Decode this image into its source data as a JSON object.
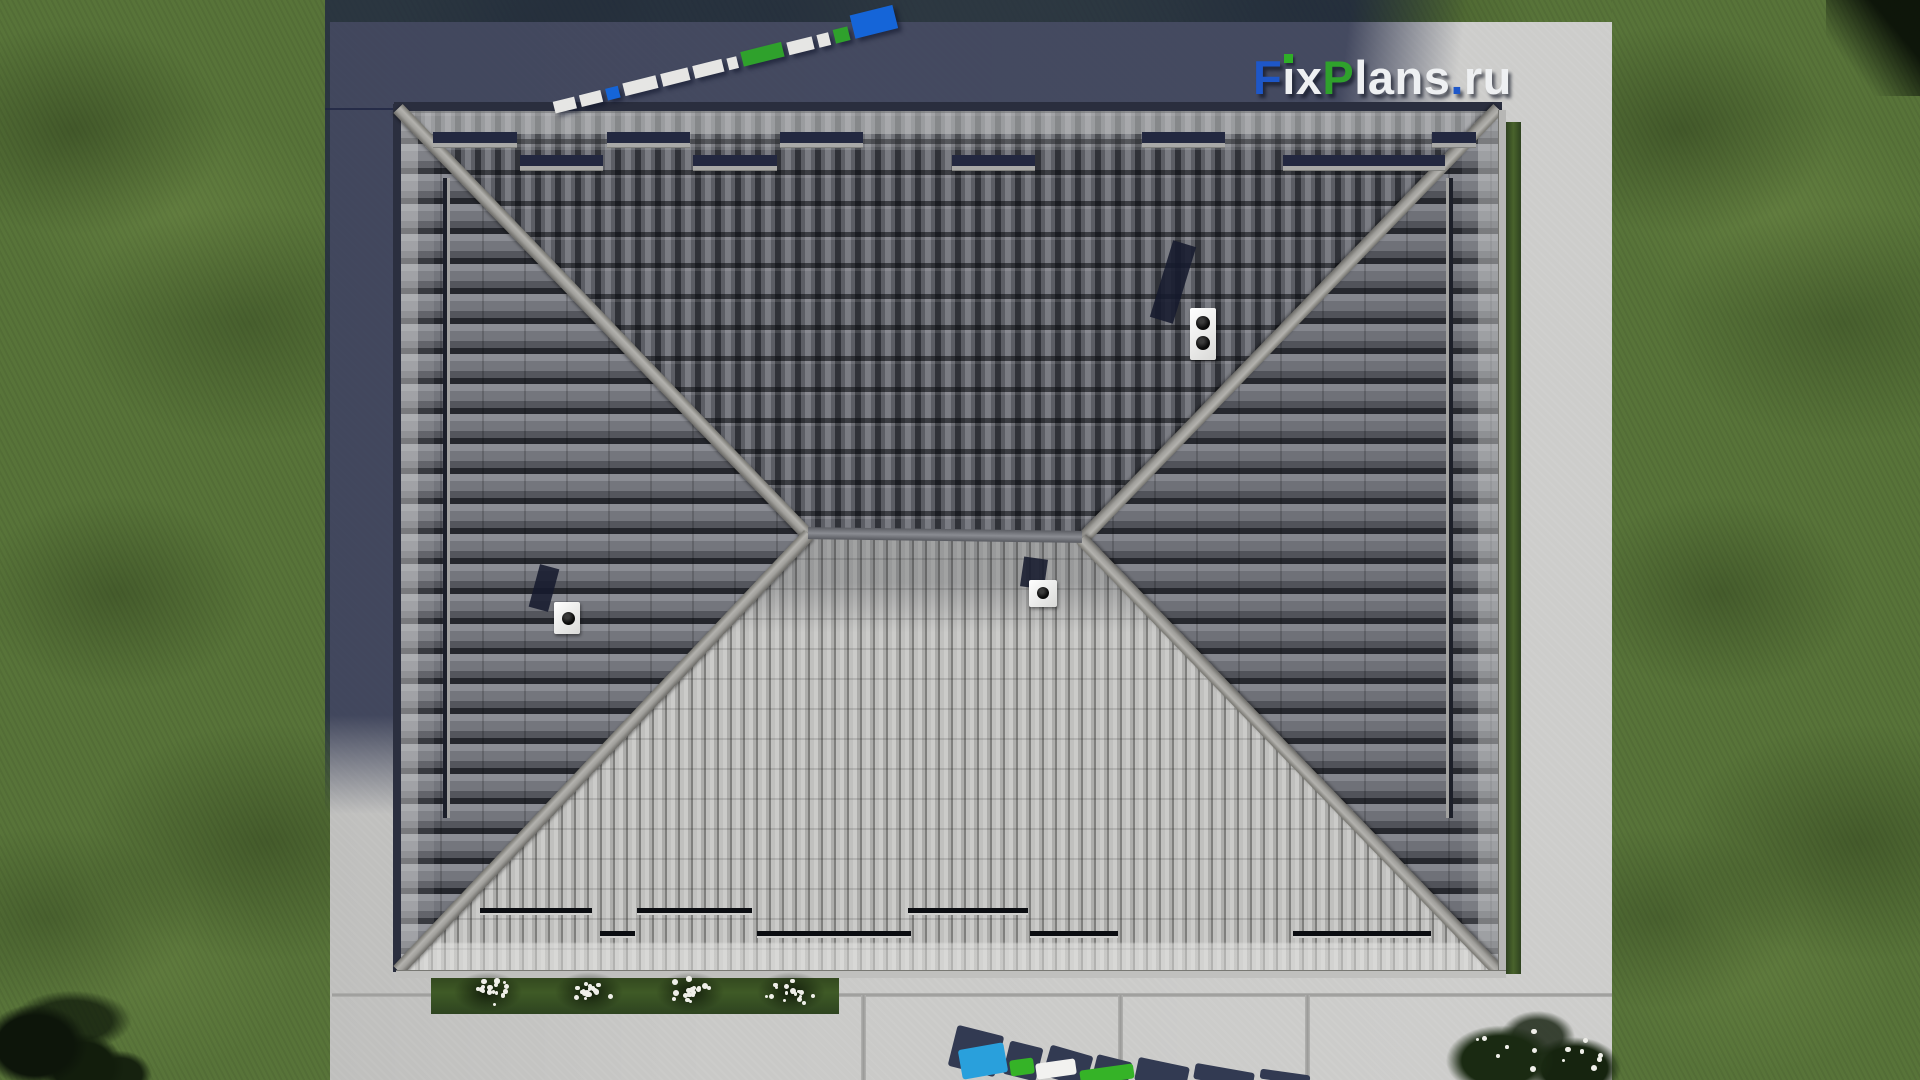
{
  "watermark_logo": {
    "text": "FixPlans.ru",
    "seg_f": "F",
    "seg_i_stem": "ı",
    "seg_x": "x",
    "seg_p": "P",
    "seg_lans": "lans",
    "seg_dot": ".",
    "seg_ru": "ru",
    "color_blue": "#1e57c8",
    "color_green": "#2fa12c",
    "color_white": "#eef0f2"
  },
  "scene_colors": {
    "grass": "#587439",
    "concrete": "#c9c9c7",
    "house_shadow": "#1e2542",
    "roof_north_tiles": "#4a4c52",
    "roof_south_tiles": "#b3b3b1",
    "roof_side_tiles": "#5e6067",
    "hip_cap": "#a6a5a1",
    "hedge_green": "#3f5a26",
    "azure_block": "#29a0dc"
  },
  "scalebar_blocks": [
    {
      "w": 22,
      "h": 12,
      "c": "#e6e6e4"
    },
    {
      "w": 22,
      "h": 12,
      "c": "#e6e6e4"
    },
    {
      "w": 13,
      "h": 12,
      "c": "#1565d8"
    },
    {
      "w": 34,
      "h": 13,
      "c": "#e6e6e4"
    },
    {
      "w": 28,
      "h": 13,
      "c": "#e6e6e4"
    },
    {
      "w": 30,
      "h": 13,
      "c": "#e6e6e4"
    },
    {
      "w": 10,
      "h": 12,
      "c": "#e6e6e4"
    },
    {
      "w": 42,
      "h": 15,
      "c": "#2fa12c"
    },
    {
      "w": 26,
      "h": 13,
      "c": "#e6e6e4"
    },
    {
      "w": 12,
      "h": 13,
      "c": "#e6e6e4"
    },
    {
      "w": 15,
      "h": 14,
      "c": "#2fa12c"
    },
    {
      "w": 44,
      "h": 24,
      "c": "#1565d8"
    }
  ],
  "bottom_mark": {
    "shadows": [
      {
        "x": 22,
        "y": 8,
        "w": 48,
        "h": 42,
        "r": 14
      },
      {
        "x": 76,
        "y": 22,
        "w": 34,
        "h": 34,
        "r": 14
      },
      {
        "x": 116,
        "y": 28,
        "w": 44,
        "h": 32,
        "r": 16
      },
      {
        "x": 164,
        "y": 36,
        "w": 36,
        "h": 26,
        "r": 14
      },
      {
        "x": 206,
        "y": 40,
        "w": 52,
        "h": 24,
        "r": 12
      },
      {
        "x": 264,
        "y": 46,
        "w": 60,
        "h": 16,
        "r": 10
      },
      {
        "x": 330,
        "y": 50,
        "w": 50,
        "h": 10,
        "r": 8
      }
    ],
    "tops": [
      {
        "x": 30,
        "y": 24,
        "w": 46,
        "h": 30,
        "r": -10,
        "c": "#29a0dc"
      },
      {
        "x": 80,
        "y": 37,
        "w": 24,
        "h": 16,
        "r": -8,
        "c": "#35b327"
      },
      {
        "x": 106,
        "y": 39,
        "w": 40,
        "h": 16,
        "r": -8,
        "c": "#f2f2f0"
      },
      {
        "x": 150,
        "y": 45,
        "w": 54,
        "h": 15,
        "r": -8,
        "c": "#35b327"
      }
    ],
    "shadow_color": "#323a52"
  },
  "roof_rails": {
    "north_upper": [
      [
        35,
        84
      ],
      [
        209,
        83
      ],
      [
        382,
        83
      ],
      [
        744,
        83
      ],
      [
        1034,
        44
      ]
    ],
    "north_lower": [
      [
        122,
        83
      ],
      [
        295,
        84
      ],
      [
        554,
        83
      ],
      [
        885,
        162
      ]
    ],
    "north_upper_y": 24,
    "north_lower_y": 47,
    "south_upper": [
      [
        82,
        112
      ],
      [
        239,
        115
      ],
      [
        510,
        120
      ]
    ],
    "south_lower": [
      [
        202,
        35
      ],
      [
        359,
        154
      ],
      [
        632,
        88
      ],
      [
        895,
        138
      ]
    ],
    "south_upper_y": 800,
    "south_lower_y": 823
  },
  "garden": {
    "bush_centers": [
      57,
      158,
      259,
      360
    ],
    "dots_per_bush": 18
  },
  "corner_bush": {
    "dots": 14
  }
}
